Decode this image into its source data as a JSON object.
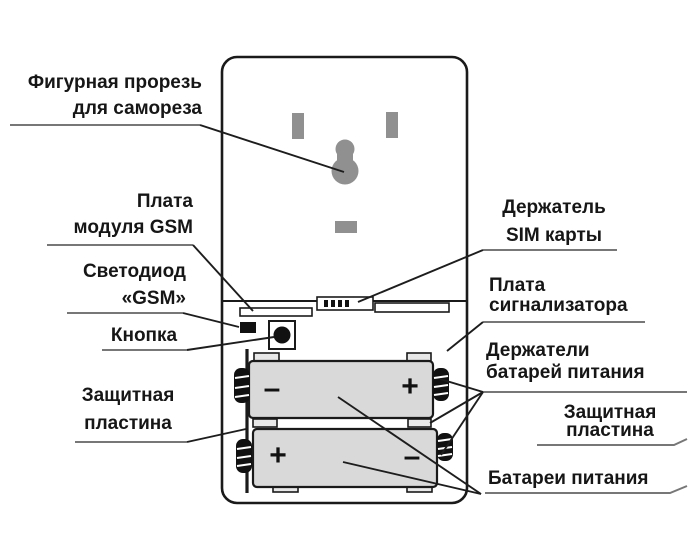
{
  "diagram": {
    "title_domain": "battery-compartment-diagram",
    "labels": {
      "keyhole": "Фигурная прорезь\nдля самореза",
      "gsm_board": "Плата\nмодуля GSM",
      "led": "Светодиод\n«GSM»",
      "button": "Кнопка",
      "plate_left": "Защитная\nпластина",
      "sim_holder": "Держатель\nSIM карты",
      "signal_board": "Плата\nсигнализатора",
      "battery_holders": "Держатели\nбатарей питания",
      "plate_right": "Защитная\nпластина",
      "batteries": "Батареи питания"
    },
    "battery_top": {
      "left_sign": "–",
      "right_sign": "+"
    },
    "battery_bottom": {
      "left_sign": "+",
      "right_sign": "–"
    },
    "colors": {
      "line": "#1a1a1a",
      "underline": "#777777",
      "gray_shape": "#909090",
      "battery_fill": "#d9d9d9",
      "background": "#ffffff"
    }
  }
}
